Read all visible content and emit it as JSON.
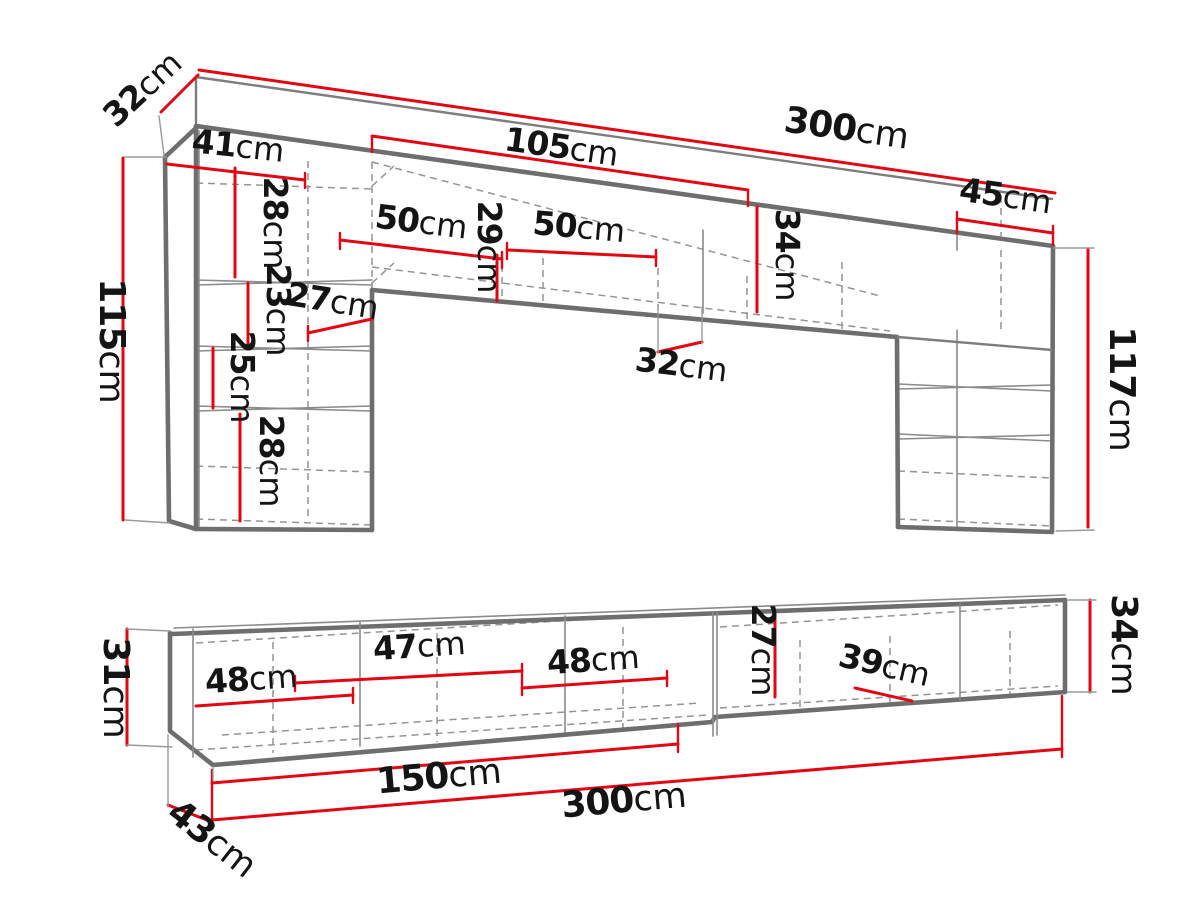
{
  "diagram_title": "Wall unit and TV stand dimension drawing",
  "colors": {
    "dimension_red": "#e30613",
    "outline_gray": "#6e6e6e",
    "hidden_line_gray": "#949494",
    "label_black": "#141414",
    "background": "#ffffff"
  },
  "wall_unit": {
    "name": "wall unit upper view",
    "dims": {
      "depth_top": {
        "value": "32",
        "unit": "cm"
      },
      "total_width": {
        "value": "300",
        "unit": "cm"
      },
      "mid_width": {
        "value": "105",
        "unit": "cm"
      },
      "left_cab_width": {
        "value": "41",
        "unit": "cm"
      },
      "shelf_h_28a": {
        "value": "28",
        "unit": "cm"
      },
      "cab50_left": {
        "value": "50",
        "unit": "cm"
      },
      "inner_h_29": {
        "value": "29",
        "unit": "cm"
      },
      "cab50_right": {
        "value": "50",
        "unit": "cm"
      },
      "band_h_34": {
        "value": "34",
        "unit": "cm"
      },
      "right_cab_width": {
        "value": "45",
        "unit": "cm"
      },
      "shelf_h_23": {
        "value": "23",
        "unit": "cm"
      },
      "shelf_depth_27": {
        "value": "27",
        "unit": "cm"
      },
      "shelf_h_25": {
        "value": "25",
        "unit": "cm"
      },
      "shelf_h_28b": {
        "value": "28",
        "unit": "cm"
      },
      "left_height": {
        "value": "115",
        "unit": "cm"
      },
      "mid_depth": {
        "value": "32",
        "unit": "cm"
      },
      "right_height": {
        "value": "117",
        "unit": "cm"
      }
    }
  },
  "tv_stand": {
    "name": "tv stand lower view",
    "dims": {
      "left_height_31": {
        "value": "31",
        "unit": "cm"
      },
      "comp_48a": {
        "value": "48",
        "unit": "cm"
      },
      "comp_47": {
        "value": "47",
        "unit": "cm"
      },
      "comp_48b": {
        "value": "48",
        "unit": "cm"
      },
      "inner_h_27": {
        "value": "27",
        "unit": "cm"
      },
      "comp_39": {
        "value": "39",
        "unit": "cm"
      },
      "right_height_34": {
        "value": "34",
        "unit": "cm"
      },
      "half_width_150": {
        "value": "150",
        "unit": "cm"
      },
      "total_width_300": {
        "value": "300",
        "unit": "cm"
      },
      "depth_43": {
        "value": "43",
        "unit": "cm"
      }
    }
  }
}
